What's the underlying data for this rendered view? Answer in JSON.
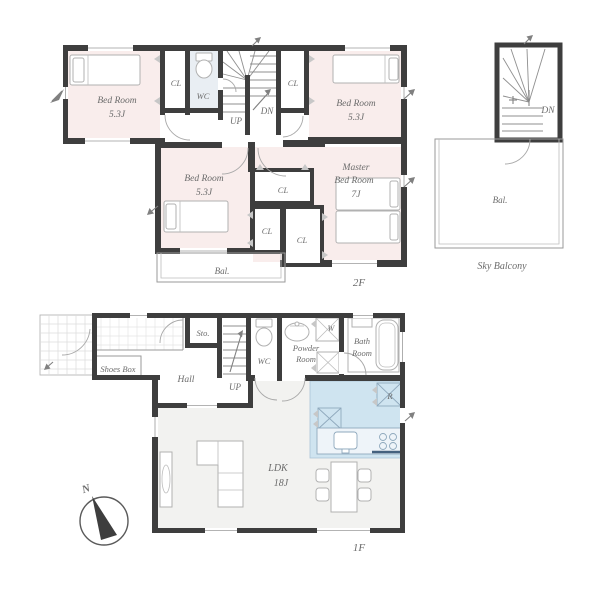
{
  "document_type": "floor-plan",
  "floor2": {
    "floor_label": "2F",
    "bedroom_nw": {
      "name": "Bed Room",
      "size": "5.3J"
    },
    "bedroom_ne": {
      "name": "Bed Room",
      "size": "5.3J"
    },
    "bedroom_mid": {
      "name": "Bed Room",
      "size": "5.3J"
    },
    "master": {
      "name_line1": "Master",
      "name_line2": "Bed Room",
      "size": "7J"
    },
    "wc": "WC",
    "closet": "CL",
    "up": "UP",
    "dn": "DN",
    "balcony": "Bal."
  },
  "sky": {
    "balcony": "Bal.",
    "label": "Sky Balcony",
    "dn": "DN"
  },
  "floor1": {
    "floor_label": "1F",
    "shoes_box": "Shoes Box",
    "hall": "Hall",
    "storage": "Sto.",
    "up": "UP",
    "wc": "WC",
    "powder_line1": "Powder",
    "powder_line2": "Room",
    "washer": "W",
    "bath_line1": "Bath",
    "bath_line2": "Room",
    "fridge": "R",
    "ldk_name": "LDK",
    "ldk_size": "18J"
  },
  "compass": {
    "north": "N"
  },
  "colors": {
    "wall": "#3e3e3e",
    "bedroom_fill": "#f9edec",
    "wc_fill": "#e9eef3",
    "kitchen_fill": "#cfe4f0",
    "ldk_fill": "#f2f2f0",
    "label_text": "#6b6b6b"
  }
}
